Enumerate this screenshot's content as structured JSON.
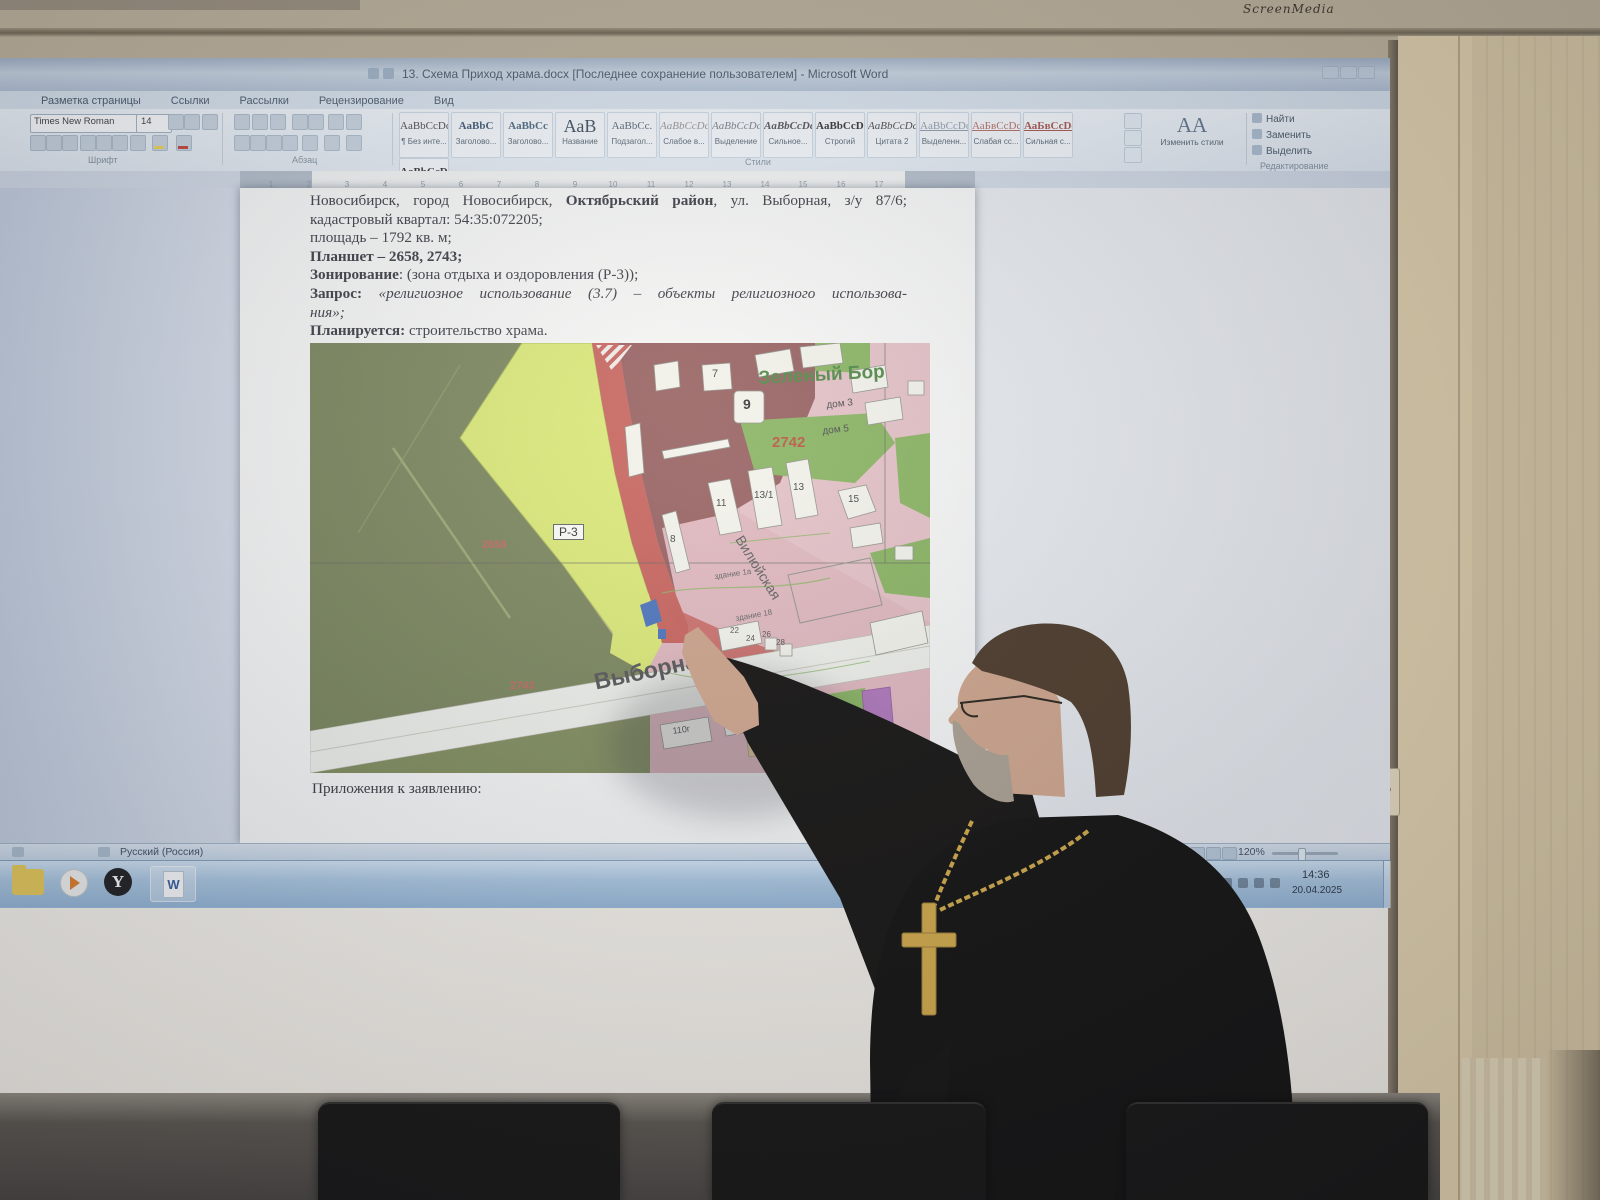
{
  "bezel": {
    "brand": "ScreenMedia"
  },
  "word": {
    "title": "13. Схема Приход храма.docx [Последнее сохранение пользователем] - Microsoft Word",
    "tabs": [
      {
        "label": "Разметка страницы"
      },
      {
        "label": "Ссылки"
      },
      {
        "label": "Рассылки"
      },
      {
        "label": "Рецензирование"
      },
      {
        "label": "Вид"
      }
    ],
    "font": {
      "name": "Times New Roman",
      "size": "14",
      "group": "Шрифт"
    },
    "paragraph_group": "Абзац",
    "styles_group": "Стили",
    "styles": [
      {
        "sample": "AaBbCcDc",
        "label": "¶ Без инте...",
        "color": "#3a3a3a"
      },
      {
        "sample": "AaBbC",
        "label": "Заголово...",
        "color": "#2e4a66",
        "bold": true
      },
      {
        "sample": "AaBbCc",
        "label": "Заголово...",
        "color": "#3e5a74",
        "bold": true
      },
      {
        "sample": "АаВ",
        "label": "Название",
        "color": "#2c3e50",
        "big": true
      },
      {
        "sample": "AaBbCc.",
        "label": "Подзагол...",
        "color": "#4a5a6a"
      },
      {
        "sample": "AaBbCcDc",
        "label": "Слабое в...",
        "color": "#8c8c8c",
        "italic": true
      },
      {
        "sample": "AaBbCcDc",
        "label": "Выделение",
        "color": "#73737f",
        "italic": true
      },
      {
        "sample": "AaBbCcDc",
        "label": "Сильное...",
        "color": "#44444c",
        "bold": true,
        "italic": true
      },
      {
        "sample": "AaBbCcDc",
        "label": "Строгий",
        "color": "#222222",
        "bold": true
      },
      {
        "sample": "AaBbCcDc",
        "label": "Цитата 2",
        "color": "#3a3a3a",
        "italic": true
      },
      {
        "sample": "AaBbCcDc",
        "label": "Выделенн...",
        "color": "#8a94a4",
        "underline": true
      },
      {
        "sample": "АаБвСсDc",
        "label": "Слабая сс...",
        "color": "#b0645a",
        "underline": true
      },
      {
        "sample": "АаБвСсDc",
        "label": "Сильная с...",
        "color": "#a04a42",
        "bold": true,
        "underline": true
      },
      {
        "sample": "AaBbCcDc",
        "label": "Название...",
        "color": "#222222",
        "bold": true
      }
    ],
    "change_styles": {
      "glyph": "АА",
      "label": "Изменить стили"
    },
    "editing": {
      "group": "Редактирование",
      "find": "Найти",
      "replace": "Заменить",
      "select": "Выделить"
    },
    "ruler_numbers": [
      "1",
      "2",
      "3",
      "4",
      "5",
      "6",
      "7",
      "8",
      "9",
      "10",
      "11",
      "12",
      "13",
      "14",
      "15",
      "16",
      "17"
    ],
    "document": {
      "p1_pre": "Новосибирск, город Новосибирск, ",
      "p1_bold": "Октябрьский район",
      "p1_post": ", ул. Выборная, з/у 87/6;",
      "p2": "кадастровый квартал: 54:35:072205;",
      "p3": "площадь – 1792 кв. м;",
      "p4": "Планшет – 2658, 2743;",
      "p5_bold": "Зонирование",
      "p5_rest": ": (зона отдыха и оздоровления (Р-3));",
      "p6_bold": "Запрос:",
      "p6_italic": " «религиозное использование (3.7) – объекты религиозного использова-",
      "p7_italic": "ния»;",
      "p8_bold": "Планируется:",
      "p8_rest": "  строительство храма.",
      "attachments": "Приложения к заявлению:"
    },
    "status": {
      "language": "Русский (Россия)",
      "zoom": "120%"
    },
    "taskbar": {
      "icons": [
        "folder",
        "media-player",
        "yandex",
        "word-document"
      ],
      "yandex_glyph": "Y",
      "word_glyph": "W",
      "tray_lang": "RU",
      "time": "14:36",
      "date": "20.04.2025"
    }
  },
  "map": {
    "labels": [
      {
        "text": "Зеленый Бор",
        "x": 448,
        "y": 26,
        "size": 19,
        "color": "#3f7d33",
        "bold": true,
        "rot": -3
      },
      {
        "text": "дом 3",
        "x": 516,
        "y": 58,
        "size": 10,
        "color": "#3a3a3a",
        "rot": -6
      },
      {
        "text": "дом 5",
        "x": 512,
        "y": 84,
        "size": 10,
        "color": "#3a3a3a",
        "rot": -6
      },
      {
        "text": "2742",
        "x": 462,
        "y": 92,
        "size": 15,
        "color": "#b5442e",
        "bold": true
      },
      {
        "text": "Р-3",
        "x": 243,
        "y": 181,
        "size": 12,
        "color": "#1a1a1a",
        "box": true
      },
      {
        "text": "2658",
        "x": 172,
        "y": 197,
        "size": 11,
        "color": "#c05a50",
        "bold": true
      },
      {
        "text": "2743",
        "x": 200,
        "y": 338,
        "size": 11,
        "color": "#c05a50",
        "bold": true
      },
      {
        "text": "Выборная",
        "x": 282,
        "y": 328,
        "size": 23,
        "color": "#474747",
        "bold": true,
        "rot": -12
      },
      {
        "text": "Вилюйская",
        "x": 435,
        "y": 190,
        "size": 14,
        "color": "#4f4f4f",
        "rot": 58
      },
      {
        "text": "7",
        "x": 402,
        "y": 26,
        "size": 11,
        "color": "#333333"
      },
      {
        "text": "9",
        "x": 433,
        "y": 54,
        "size": 14,
        "color": "#222222",
        "bold": true
      },
      {
        "text": "11",
        "x": 406,
        "y": 156,
        "size": 10,
        "color": "#333333"
      },
      {
        "text": "13/1",
        "x": 444,
        "y": 148,
        "size": 10,
        "color": "#333333"
      },
      {
        "text": "13",
        "x": 483,
        "y": 140,
        "size": 10,
        "color": "#333333"
      },
      {
        "text": "8",
        "x": 360,
        "y": 192,
        "size": 10,
        "color": "#333333"
      },
      {
        "text": "15",
        "x": 538,
        "y": 152,
        "size": 10,
        "color": "#333333"
      },
      {
        "text": "здание 1а",
        "x": 404,
        "y": 230,
        "size": 8,
        "color": "#555555",
        "rot": -8
      },
      {
        "text": "здание 18",
        "x": 425,
        "y": 272,
        "size": 8,
        "color": "#555555",
        "rot": -10
      },
      {
        "text": "22",
        "x": 420,
        "y": 284,
        "size": 8,
        "color": "#444444"
      },
      {
        "text": "24",
        "x": 436,
        "y": 292,
        "size": 8,
        "color": "#444444"
      },
      {
        "text": "26",
        "x": 452,
        "y": 288,
        "size": 8,
        "color": "#444444"
      },
      {
        "text": "28",
        "x": 466,
        "y": 296,
        "size": 8,
        "color": "#444444"
      },
      {
        "text": "110г",
        "x": 362,
        "y": 384,
        "size": 9,
        "color": "#444444",
        "rot": -8
      },
      {
        "text": "24",
        "x": 412,
        "y": 372,
        "size": 9,
        "color": "#444444"
      }
    ]
  }
}
